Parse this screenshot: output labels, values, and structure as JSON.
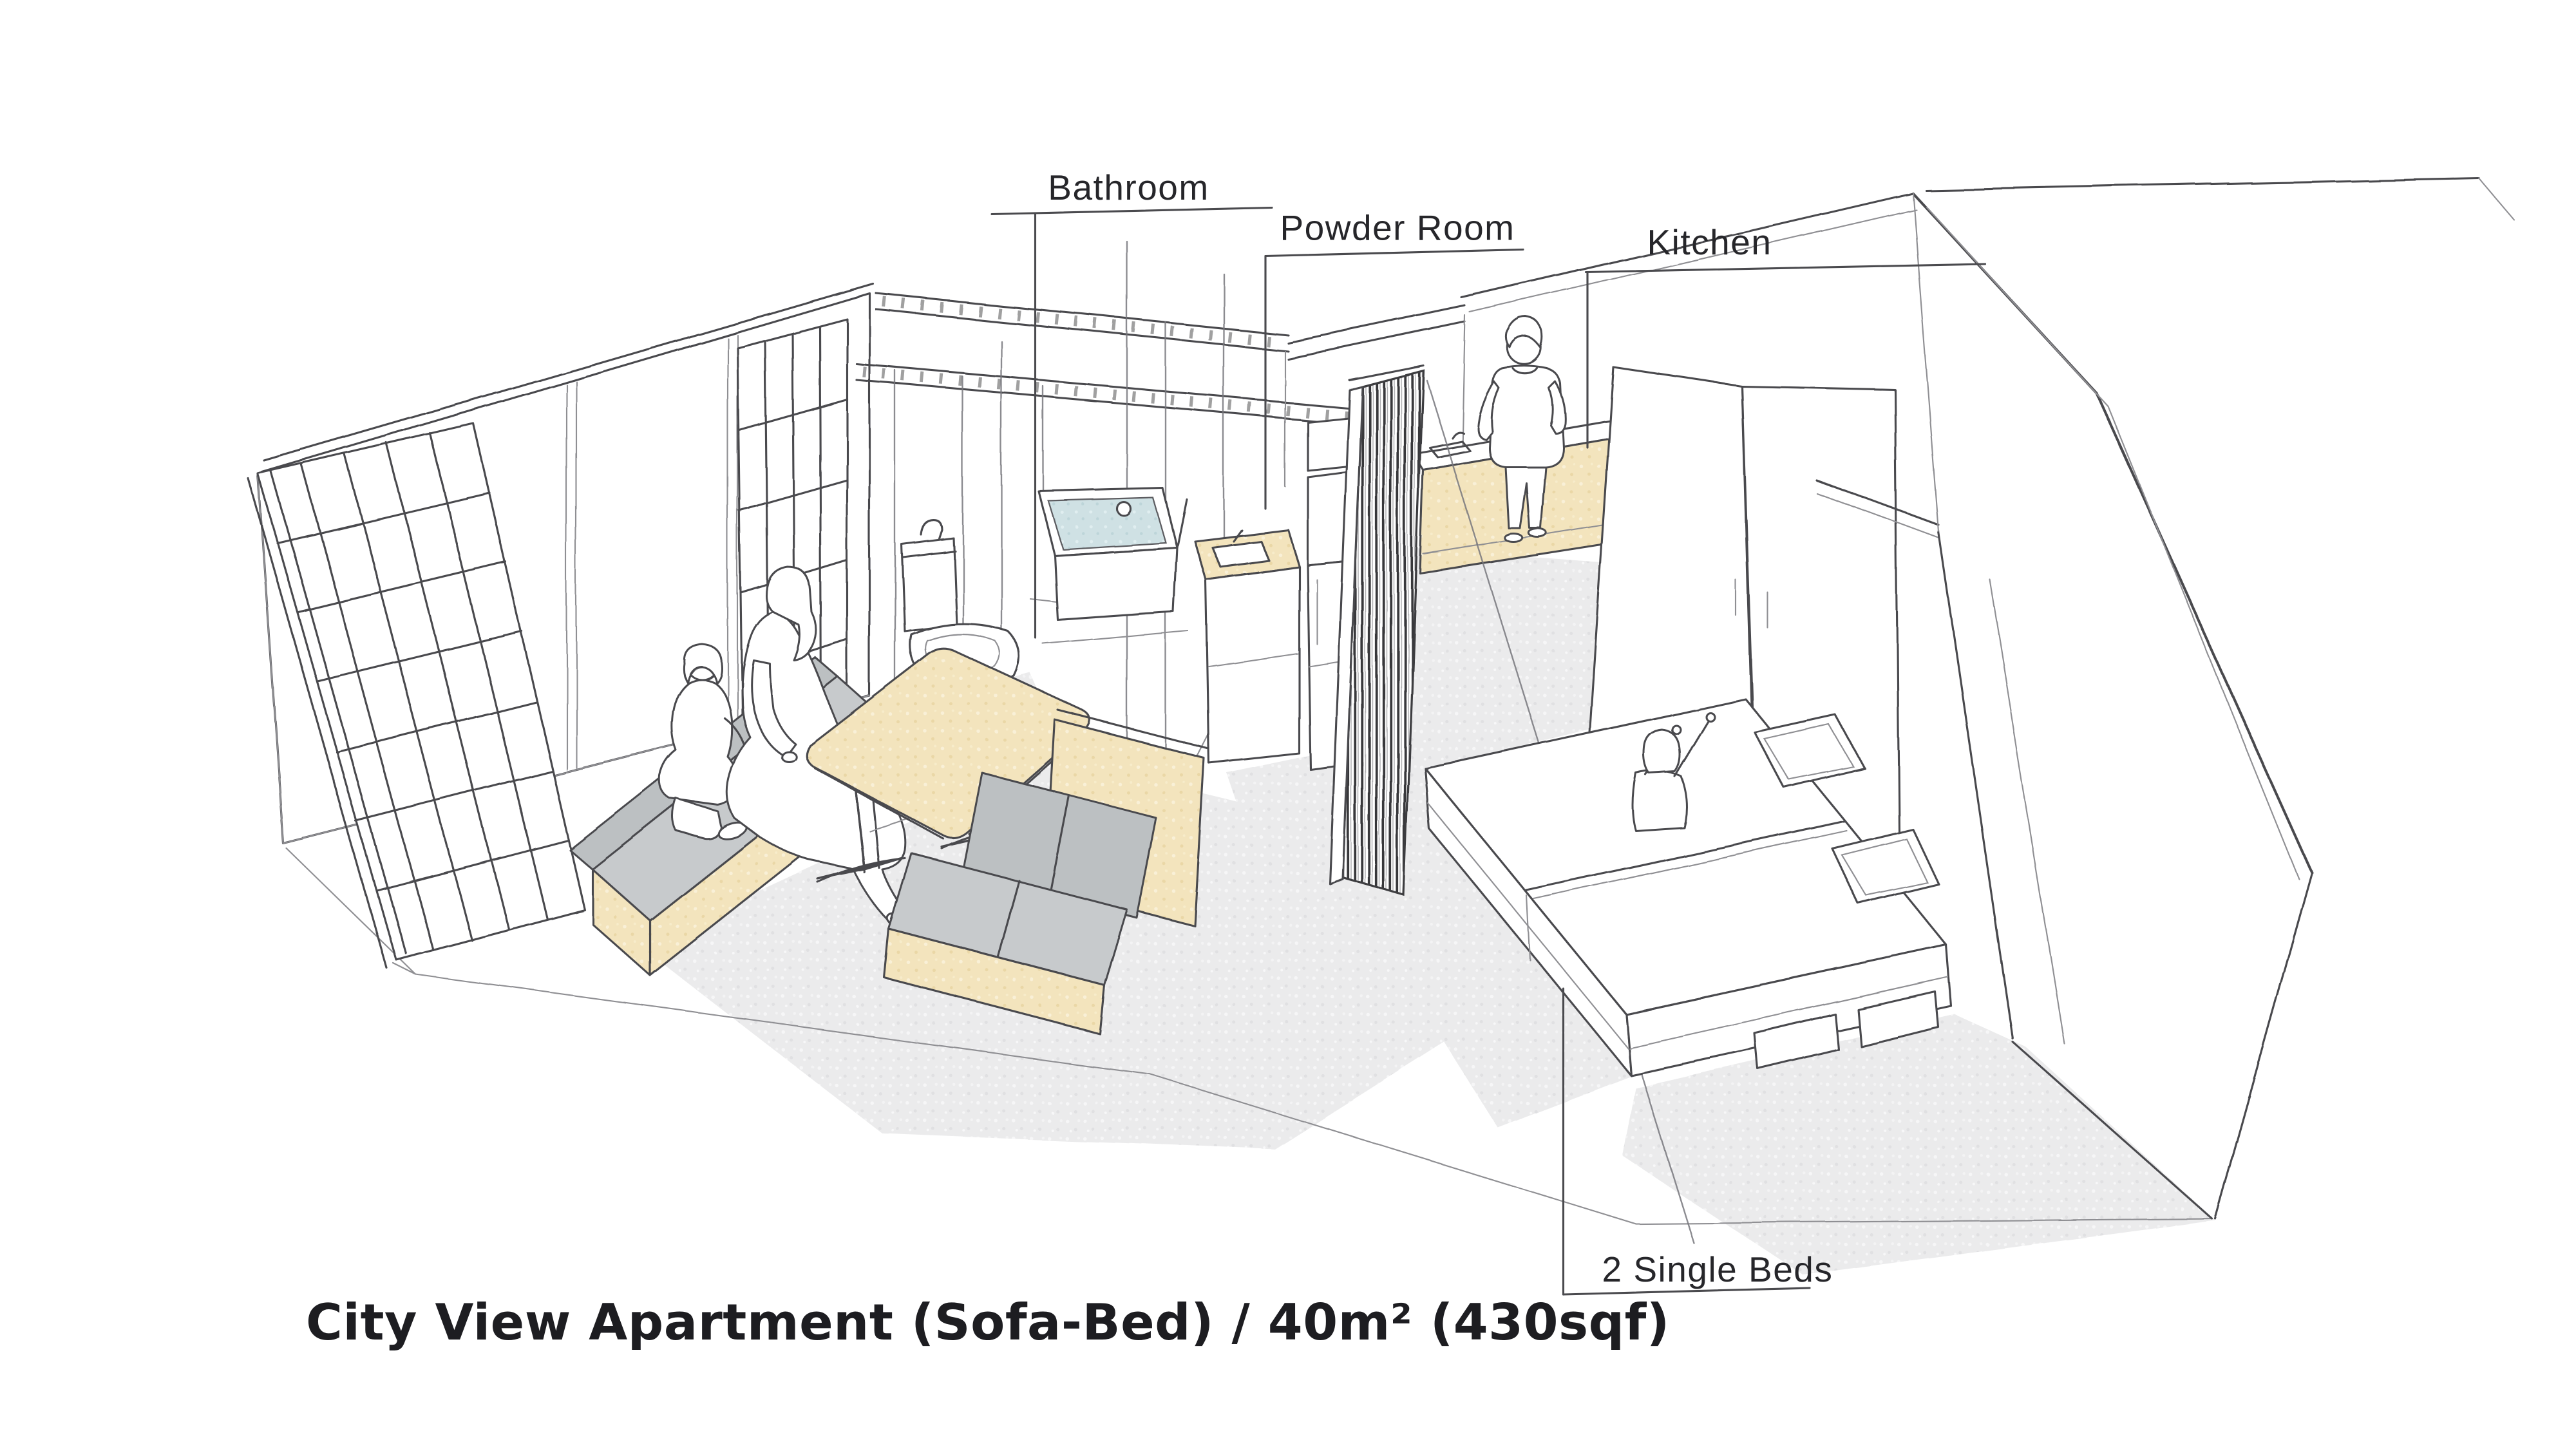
{
  "page": {
    "background": "#ffffff",
    "style": "hand-drawn axonometric interior sketch"
  },
  "title": {
    "text": "City View Apartment (Sofa-Bed) / 40m² (430sqf)"
  },
  "annotations": [
    {
      "id": "bathroom",
      "label": "Bathroom"
    },
    {
      "id": "powder-room",
      "label": "Powder Room"
    },
    {
      "id": "kitchen",
      "label": "Kitchen"
    },
    {
      "id": "single-beds",
      "label": "2 Single Beds"
    }
  ],
  "rooms": [
    "Bathroom",
    "Powder Room",
    "Kitchen",
    "Living / Dining",
    "Bedroom"
  ],
  "furniture": [
    "shoji sliding screens",
    "sofa bench with wood base (x2)",
    "wood dining table",
    "toilet",
    "bathtub",
    "washbasin cabinet",
    "refrigerator with microwave",
    "louvered partition screen",
    "kitchen counter",
    "wardrobe cabinets",
    "two single beds with pillows and under-bed drawers"
  ],
  "people": [
    {
      "pose": "child kneeling on sofa",
      "location": "living room"
    },
    {
      "pose": "woman sitting on sofa",
      "location": "living room"
    },
    {
      "pose": "man standing at counter",
      "location": "kitchen"
    },
    {
      "pose": "child sitting with raised arms",
      "location": "bedroom bed"
    }
  ],
  "colors": {
    "line": "#4a4a4e",
    "wood": "#f3e4bd",
    "cushion_gray": "#c7cacc",
    "water_blue": "#cfe1e4",
    "floor_gray": "#ebebec",
    "text": "#26262a"
  }
}
